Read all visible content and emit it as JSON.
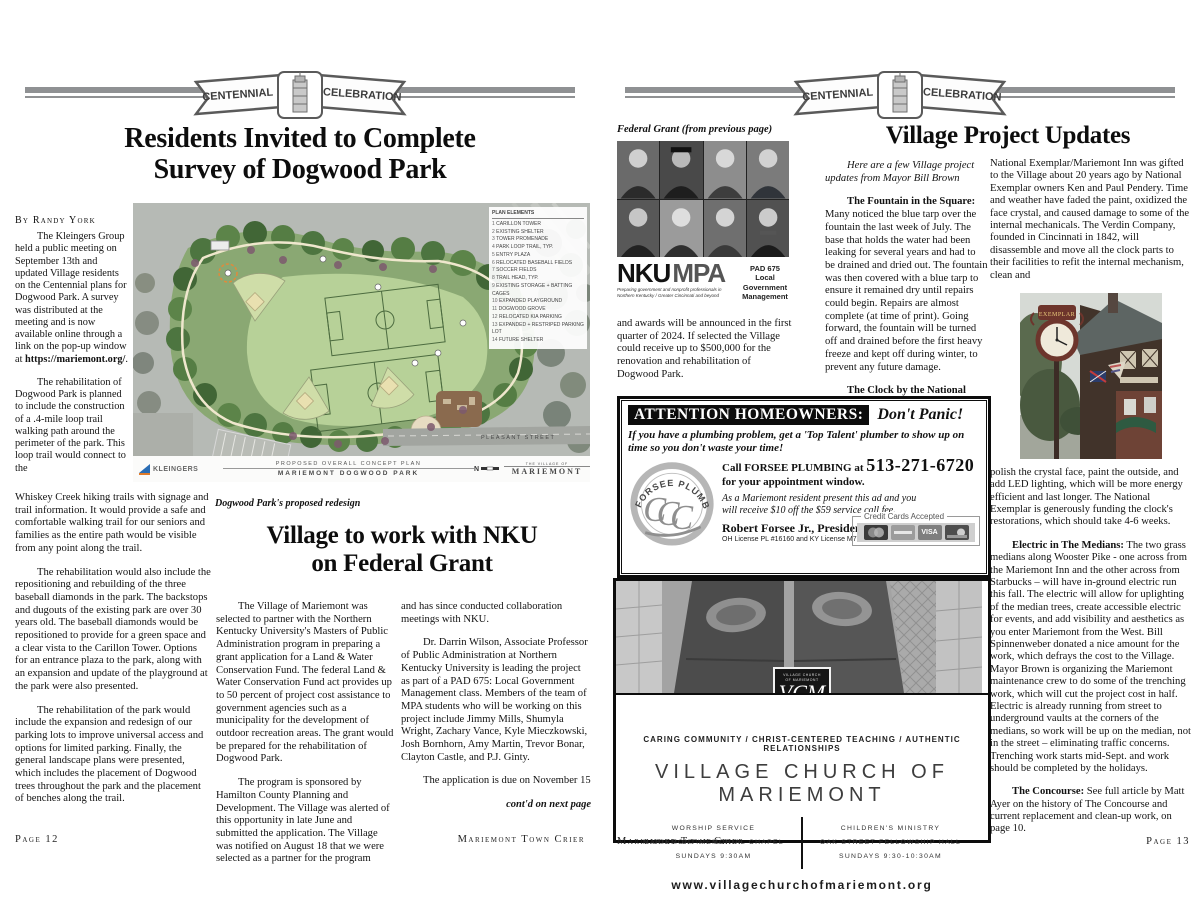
{
  "banner": {
    "left": "CENTENNIAL",
    "right": "CELEBRATION"
  },
  "left": {
    "headline_a": "Residents Invited to Complete",
    "headline_b": "Survey of Dogwood Park",
    "byline": "By Randy York",
    "colA": {
      "p1a": "The Kleingers Group held a public meeting on September 13th and updated Village residents on the Centennial plans for Dogwood Park. A survey was distributed at the meeting and is now available online through a link on the pop-up window at ",
      "p1b": "https://mariemont.org/",
      "p1c": ".",
      "p2": "The rehabilitation of Dogwood Park is planned to include the construction of a .4-mile loop trail walking path around the perimeter of the park. This loop trail would connect to the",
      "p2cont": "Whiskey Creek hiking trails with signage and trail information. It would provide a safe and comfortable walking trail for our seniors and families as the entire path would be visible from any point along the trail.",
      "p3": "The rehabilitation would also include the repositioning and rebuilding of the three baseball diamonds in the park. The backstops and dugouts of the existing park are over 30 years old. The baseball diamonds would be repositioned to provide for a green space and a clear vista to the Carillon Tower. Options for an entrance plaza to the park, along with an expansion and update of the playground at the park were also presented.",
      "p4": "The rehabilitation of the park would include the expansion and redesign of our parking lots to improve universal access and options for limited parking. Finally, the general landscape plans were presented, which includes the placement of Dogwood trees throughout the park and the placement of benches along the trail."
    },
    "caption": "Dogwood Park's proposed redesign",
    "headline2_a": "Village to work with NKU",
    "headline2_b": "on Federal Grant",
    "colB": {
      "p1": "The Village of Mariemont was selected to partner with the Northern Kentucky University's Masters of Public Administration program in preparing a grant application for a Land & Water Conservation Fund. The federal Land & Water Conservation Fund act provides up to 50 percent of project cost assistance to government agencies such as a municipality for the development of outdoor recreation areas. The grant would be prepared for the rehabilitation of Dogwood Park.",
      "p2": "The program is sponsored by Hamilton County Planning and Development. The Village was alerted of this opportunity in late June and submitted the application. The Village was notified on August 18 that we were selected as a partner for the program"
    },
    "colC": {
      "p1": "and has since conducted collaboration meetings with NKU.",
      "p2": "Dr. Darrin Wilson, Associate Professor of Public Administration at Northern Kentucky University is leading the project as part of a PAD 675: Local Government Management class. Members of the team of MPA students who will be working on this project include Jimmy Mills, Shumyla Wright, Zachary Vance, Kyle Mieczkowski, Josh Bornhorn, Amy Martin, Trevor Bonar, Clayton Castle, and P.J. Ginty.",
      "p3": "The application is due on November 15",
      "contd": "cont'd on next page"
    },
    "footer_page": "Page 12",
    "footer_title": "Mariemont Town Crier"
  },
  "map": {
    "legend_title": "PLAN ELEMENTS",
    "legend_items": [
      "CARILLON TOWER",
      "EXISTING SHELTER",
      "TOWER PROMENADE",
      "PARK LOOP TRAIL, TYP.",
      "ENTRY PLAZA",
      "RELOCATED BASEBALL FIELDS",
      "SOCCER FIELDS",
      "TRAIL HEAD, TYP.",
      "EXISTING STORAGE + BATTING CAGES",
      "EXPANDED PLAYGROUND",
      "DOGWOOD GROVE",
      "RELOCATED KIA PARKING",
      "EXPANDED + RESTRIPED PARKING LOT",
      "FUTURE SHELTER"
    ],
    "firm": "KLEINGERS",
    "plan_title1": "PROPOSED OVERALL CONCEPT PLAN",
    "plan_title2": "MARIEMONT DOGWOOD PARK",
    "village_pre": "THE VILLAGE OF",
    "village": "MARIEMONT",
    "street": "PLEASANT STREET",
    "north": "N"
  },
  "right": {
    "fg_caption": "Federal Grant (from previous page)",
    "nku": {
      "nku": "NKU",
      "mpa": "MPA",
      "tagline1": "Preparing government and nonprofit professionals in",
      "tagline2": "Northern Kentucky / Greater Cincinnati and beyond",
      "pad1": "PAD 675",
      "pad2": "Local",
      "pad3": "Government",
      "pad4": "Management"
    },
    "fg_text": "and awards will be announced in the first quarter of 2024. If selected the Village could receive up to $500,000 for the renovation and rehabilitation of Dogwood Park.",
    "headline": "Village Project Updates",
    "intro": "Here are a few Village project updates from Mayor Bill Brown",
    "colA": {
      "p1_lead": "The Fountain in the Square:",
      "p1": "Many noticed the blue tarp over the fountain the last week of July. The base that holds the water had been leaking for several years and had to be drained and dried out. The fountain was then covered with a blue tarp to ensure it remained dry until repairs could begin. Repairs are almost complete (at time of print). Going forward, the fountain will be turned off and drained before the first heavy freeze and kept off during winter, to prevent any future damage.",
      "p2_lead": "The Clock by the National Exemplar:",
      "p2": "The current Verdin clock that stands outside of the"
    },
    "colB": {
      "p1": "National Exemplar/Mariemont Inn was gifted to the Village about 20 years ago by National Exemplar owners Ken and Paul Pendery. Time and weather have faded the paint, oxidized the face crystal, and caused damage to some of the internal mechanicals. The Verdin Company, founded in Cincinnati in 1842, will disassemble and move all the clock parts to their facilities to refit the internal mechanism, clean and",
      "p2": "polish the crystal face, paint the outside, and add LED lighting, which will be more energy efficient and last longer. The National Exemplar is generously funding the clock's restorations, which should take 4-6 weeks.",
      "p3_lead": "Electric in The Medians:",
      "p3": "The two grass medians along Wooster Pike - one across from the Mariemont Inn and the other across from Starbucks – will have in-ground electric run this fall. The electric will allow for uplighting of the median trees, create accessible electric for events, and add visibility and aesthetics as you enter Mariemont from the West. Bill Spinnenweber donated a nice amount for the work, which defrays the cost to the Village. Mayor Brown is organizing the Mariemont maintenance crew to do some of the trenching work, which will cut the project cost in half. Electric is already running from street to underground vaults at the corners of the medians, so work will be up on the median, not in the street – eliminating traffic concerns. Trenching work starts mid-Sept. and work should be completed by the holidays.",
      "p4_lead": "The Concourse:",
      "p4": "See full article by Matt Ayer on the history of The Concourse and current replacement and clean-up work, on page 10."
    },
    "clock_sign": "EXEMPLAR",
    "footer_title": "Mariemont Town Crier",
    "footer_page": "Page 13"
  },
  "plumbing_ad": {
    "header": "ATTENTION HOMEOWNERS:",
    "panic": "Don't Panic!",
    "pitch": "If you have a plumbing problem, get a 'Top Talent' plumber to show up on time so you don't waste your time!",
    "logo_arc": "FORSEE PLUMBING",
    "call_pre": "Call FORSEE PLUMBING at",
    "phone": "513-271-6720",
    "call_post": "for your appointment window.",
    "offer": "As a Mariemont resident present this ad and you will receive $10 off the $59 service call fee.",
    "president": "Robert Forsee Jr., President",
    "license": "OH License PL #16160 and KY License M7256",
    "cc": "Credit Cards Accepted",
    "visa": "VISA"
  },
  "church_ad": {
    "tagline": "CARING COMMUNITY / CHRIST-CENTERED TEACHING / AUTHENTIC RELATIONSHIPS",
    "name": "VILLAGE CHURCH OF MARIEMONT",
    "shield_line1": "VILLAGE CHURCH",
    "shield_line2": "OF MARIEMONT",
    "monogram": "VCM",
    "left1": "WORSHIP SERVICE",
    "left2": "MARIEMONT MEMORIAL CHAPEL",
    "left3": "SUNDAYS 9:30AM",
    "right1": "CHILDREN'S MINISTRY",
    "right2": "OAK STREET FELLOWSHIP HALL",
    "right3": "SUNDAYS 9:30-10:30AM",
    "url": "www.villagechurchofmariemont.org"
  }
}
